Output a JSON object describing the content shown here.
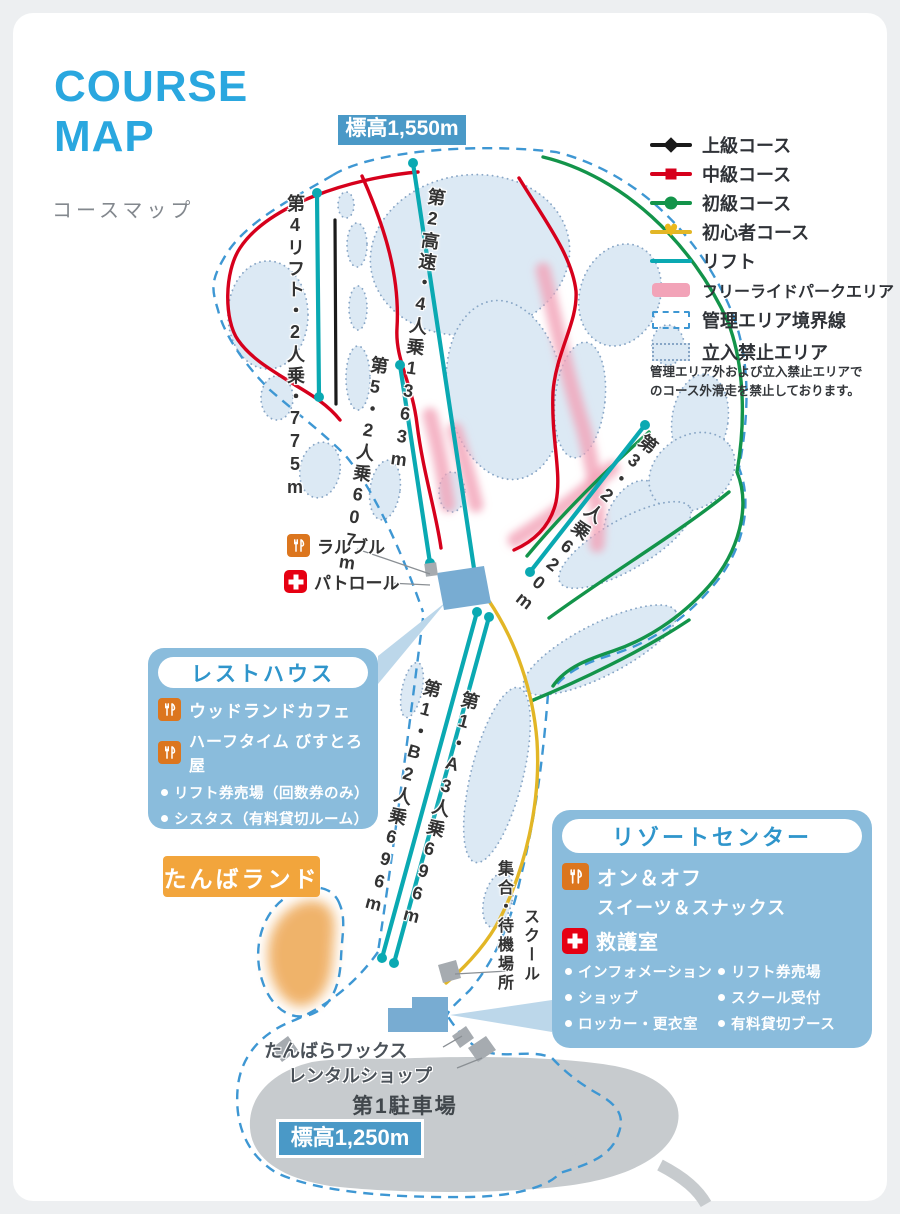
{
  "page": {
    "title_line1": "COURSE",
    "title_line2": "MAP",
    "subtitle": "コースマップ"
  },
  "elevation": {
    "top": "標高1,550m",
    "bottom": "標高1,250m"
  },
  "legend": {
    "items": [
      {
        "label": "上級コース"
      },
      {
        "label": "中級コース"
      },
      {
        "label": "初級コース"
      },
      {
        "label": "初心者コース"
      },
      {
        "label": "リフト"
      },
      {
        "label": "フリーライドパークエリア"
      },
      {
        "label": "管理エリア境界線"
      },
      {
        "label": "立入禁止エリア"
      }
    ],
    "note_line1": "管理エリア外および立入禁止エリアで",
    "note_line2": "のコース外滑走を禁止しております。"
  },
  "lifts": {
    "l4": "第4リフト・2人乗・775m",
    "l2": "第2高速・4人乗1363m",
    "l5": "第5・2人乗607m",
    "l3": "第3・2人乗620m",
    "l1a": "第1・A3人乗696m",
    "l1b": "第1・B2人乗696m"
  },
  "pois": {
    "larbre": "ラルブル",
    "patrol": "パトロール",
    "school": "スクール",
    "meeting": "集合・待機場所",
    "wax_line1": "たんばらワックス",
    "wax_line2": "レンタルショップ",
    "parking": "第1駐車場",
    "tanba_land": "たんばランド"
  },
  "rest_house": {
    "title": "レストハウス",
    "restaurants": [
      "ウッドランドカフェ",
      "ハーフタイム びすとろ屋"
    ],
    "bullets": [
      "リフト券売場（回数券のみ）",
      "シスタス（有料貸切ルーム）",
      "喫煙所"
    ]
  },
  "resort_center": {
    "title": "リゾートセンター",
    "restaurant_line1": "オン＆オフ",
    "restaurant_line2": "スイーツ＆スナックス",
    "first_aid": "救護室",
    "bullets_left": [
      "インフォメーション",
      "ショップ",
      "ロッカー・更衣室"
    ],
    "bullets_right": [
      "リフト券売場",
      "スクール受付",
      "有料貸切ブース"
    ]
  },
  "colors": {
    "accent_blue": "#2aa7df",
    "advanced": "#1a1a1a",
    "intermediate": "#d6001c",
    "beginner": "#13944a",
    "novice": "#e2b626",
    "lift": "#0aa9b2",
    "freeride": "#f2a3b8",
    "boundary": "#3e97d3",
    "no_entry_fill": "#dce9f4",
    "box_blue": "#8abcdc",
    "orange": "#f2a53c"
  }
}
